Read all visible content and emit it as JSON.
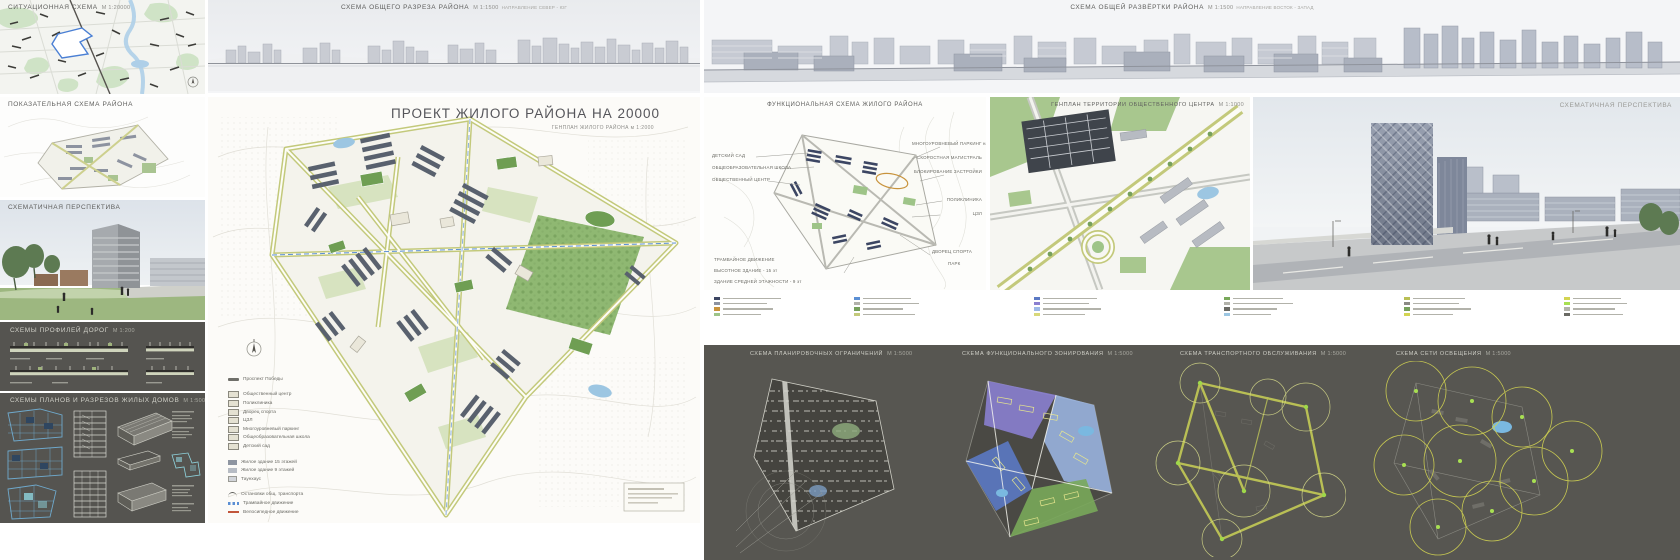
{
  "panels": {
    "situational": {
      "title": "СИТУАЦИОННАЯ СХЕМА",
      "scale": "м 1:20000"
    },
    "district_overview": {
      "title": "ПОКАЗАТЕЛЬНАЯ СХЕМА РАЙОНА"
    },
    "perspective_1": {
      "title": "СХЕМАТИЧНАЯ ПЕРСПЕКТИВА"
    },
    "road_profiles": {
      "title": "СХЕМЫ ПРОФИЛЕЙ ДОРОГ",
      "scale": "м 1:200"
    },
    "house_plans": {
      "title": "СХЕМЫ ПЛАНОВ И РАЗРЕЗОВ ЖИЛЫХ ДОМОВ",
      "scale": "м 1:500"
    },
    "general_section": {
      "title": "СХЕМА ОБЩЕГО РАЗРЕЗА РАЙОНА",
      "scale": "м 1:1500",
      "note": "направление Север - Юг"
    },
    "general_elevation": {
      "title": "СХЕМА ОБЩЕЙ РАЗВЁРТКИ РАЙОНА",
      "scale": "м 1:1500",
      "note": "направление Восток - Запад"
    },
    "masterplan": {
      "title": "ПРОЕКТ ЖИЛОГО РАЙОНА НА 20000",
      "subtitle": "ГЕНПЛАН ЖИЛОГО РАЙОНА",
      "scale": "м 1:2000"
    },
    "functional": {
      "title": "ФУНКЦИОНАЛЬНАЯ СХЕМА ЖИЛОГО РАЙОНА",
      "labels_left": [
        "ДЕТСКИЙ САД",
        "ОБЩЕОБРАЗОВАТЕЛЬНАЯ ШКОЛА",
        "ОБЩЕСТВЕННЫЙ ЦЕНТР"
      ],
      "labels_right": [
        "МНОГОУРОВНЕВЫЙ ПАРКИНГ на 800 мест",
        "СКОРОСТНАЯ МАГИСТРАЛЬ",
        "БЛОКИРОВАНИЕ ЗАСТРОЙКИ",
        "ПОЛИКЛИНИКА",
        "ЦЗЛ"
      ],
      "labels_bottom": [
        "ТРАМВАЙНОЕ ДВИЖЕНИЕ",
        "ВЫСОТНОЕ ЗДАНИЕ - 15 эт",
        "ЗДАНИЕ СРЕДНЕЙ ЭТАЖНОСТИ - 9 эт"
      ],
      "labels_bottom_right": [
        "ДВОРЕЦ СПОРТА",
        "ПАРК"
      ]
    },
    "public_center_plan": {
      "title": "ГЕНПЛАН ТЕРРИТОРИИ ОБЩЕСТВЕННОГО ЦЕНТРА",
      "scale": "м 1:1000"
    },
    "perspective_2": {
      "title": "СХЕМАТИЧНАЯ ПЕРСПЕКТИВА"
    },
    "constraints": {
      "title": "СХЕМА ПЛАНИРОВОЧНЫХ ОГРАНИЧЕНИЙ",
      "scale": "м 1:5000"
    },
    "zoning": {
      "title": "СХЕМА ФУНКЦИОНАЛЬНОГО ЗОНИРОВАНИЯ",
      "scale": "м 1:5000"
    },
    "transport": {
      "title": "СХЕМА ТРАНСПОРТНОГО ОБСЛУЖИВАНИЯ",
      "scale": "м 1:5000"
    },
    "lighting": {
      "title": "СХЕМА СЕТИ ОСВЕЩЕНИЯ",
      "scale": "м 1:5000"
    }
  },
  "masterplan_legend": {
    "items": [
      {
        "label": "Проспект Победы"
      },
      {
        "label": "Общественный центр"
      },
      {
        "label": "Поликлиника"
      },
      {
        "label": "Дворец спорта"
      },
      {
        "label": "ЦЗЛ"
      },
      {
        "label": "Многоуровневый паркинг"
      },
      {
        "label": "Общеобразовательная школа"
      },
      {
        "label": "Детский сад"
      },
      {
        "label": "Жилое здание 15 этажей"
      },
      {
        "label": "Жилое здание 9 этажей"
      },
      {
        "label": "Таунхаус"
      },
      {
        "label": "Остановки общ. транспорта"
      },
      {
        "label": "Трамвайное движение"
      },
      {
        "label": "Велосипедное движение"
      },
      {
        "label": "Аллея пешеходных связей"
      }
    ]
  },
  "colors": {
    "site_outline": "#4a7fd4",
    "road_olive": "#c3c97b",
    "park_green": "#8fb872",
    "building_slate": "#59616e",
    "blueprint_blue": "#6fa9cc",
    "dark_panel": "#555450",
    "transport_yellow": "#b9bf55",
    "lighting_yellow": "#d3d452"
  }
}
